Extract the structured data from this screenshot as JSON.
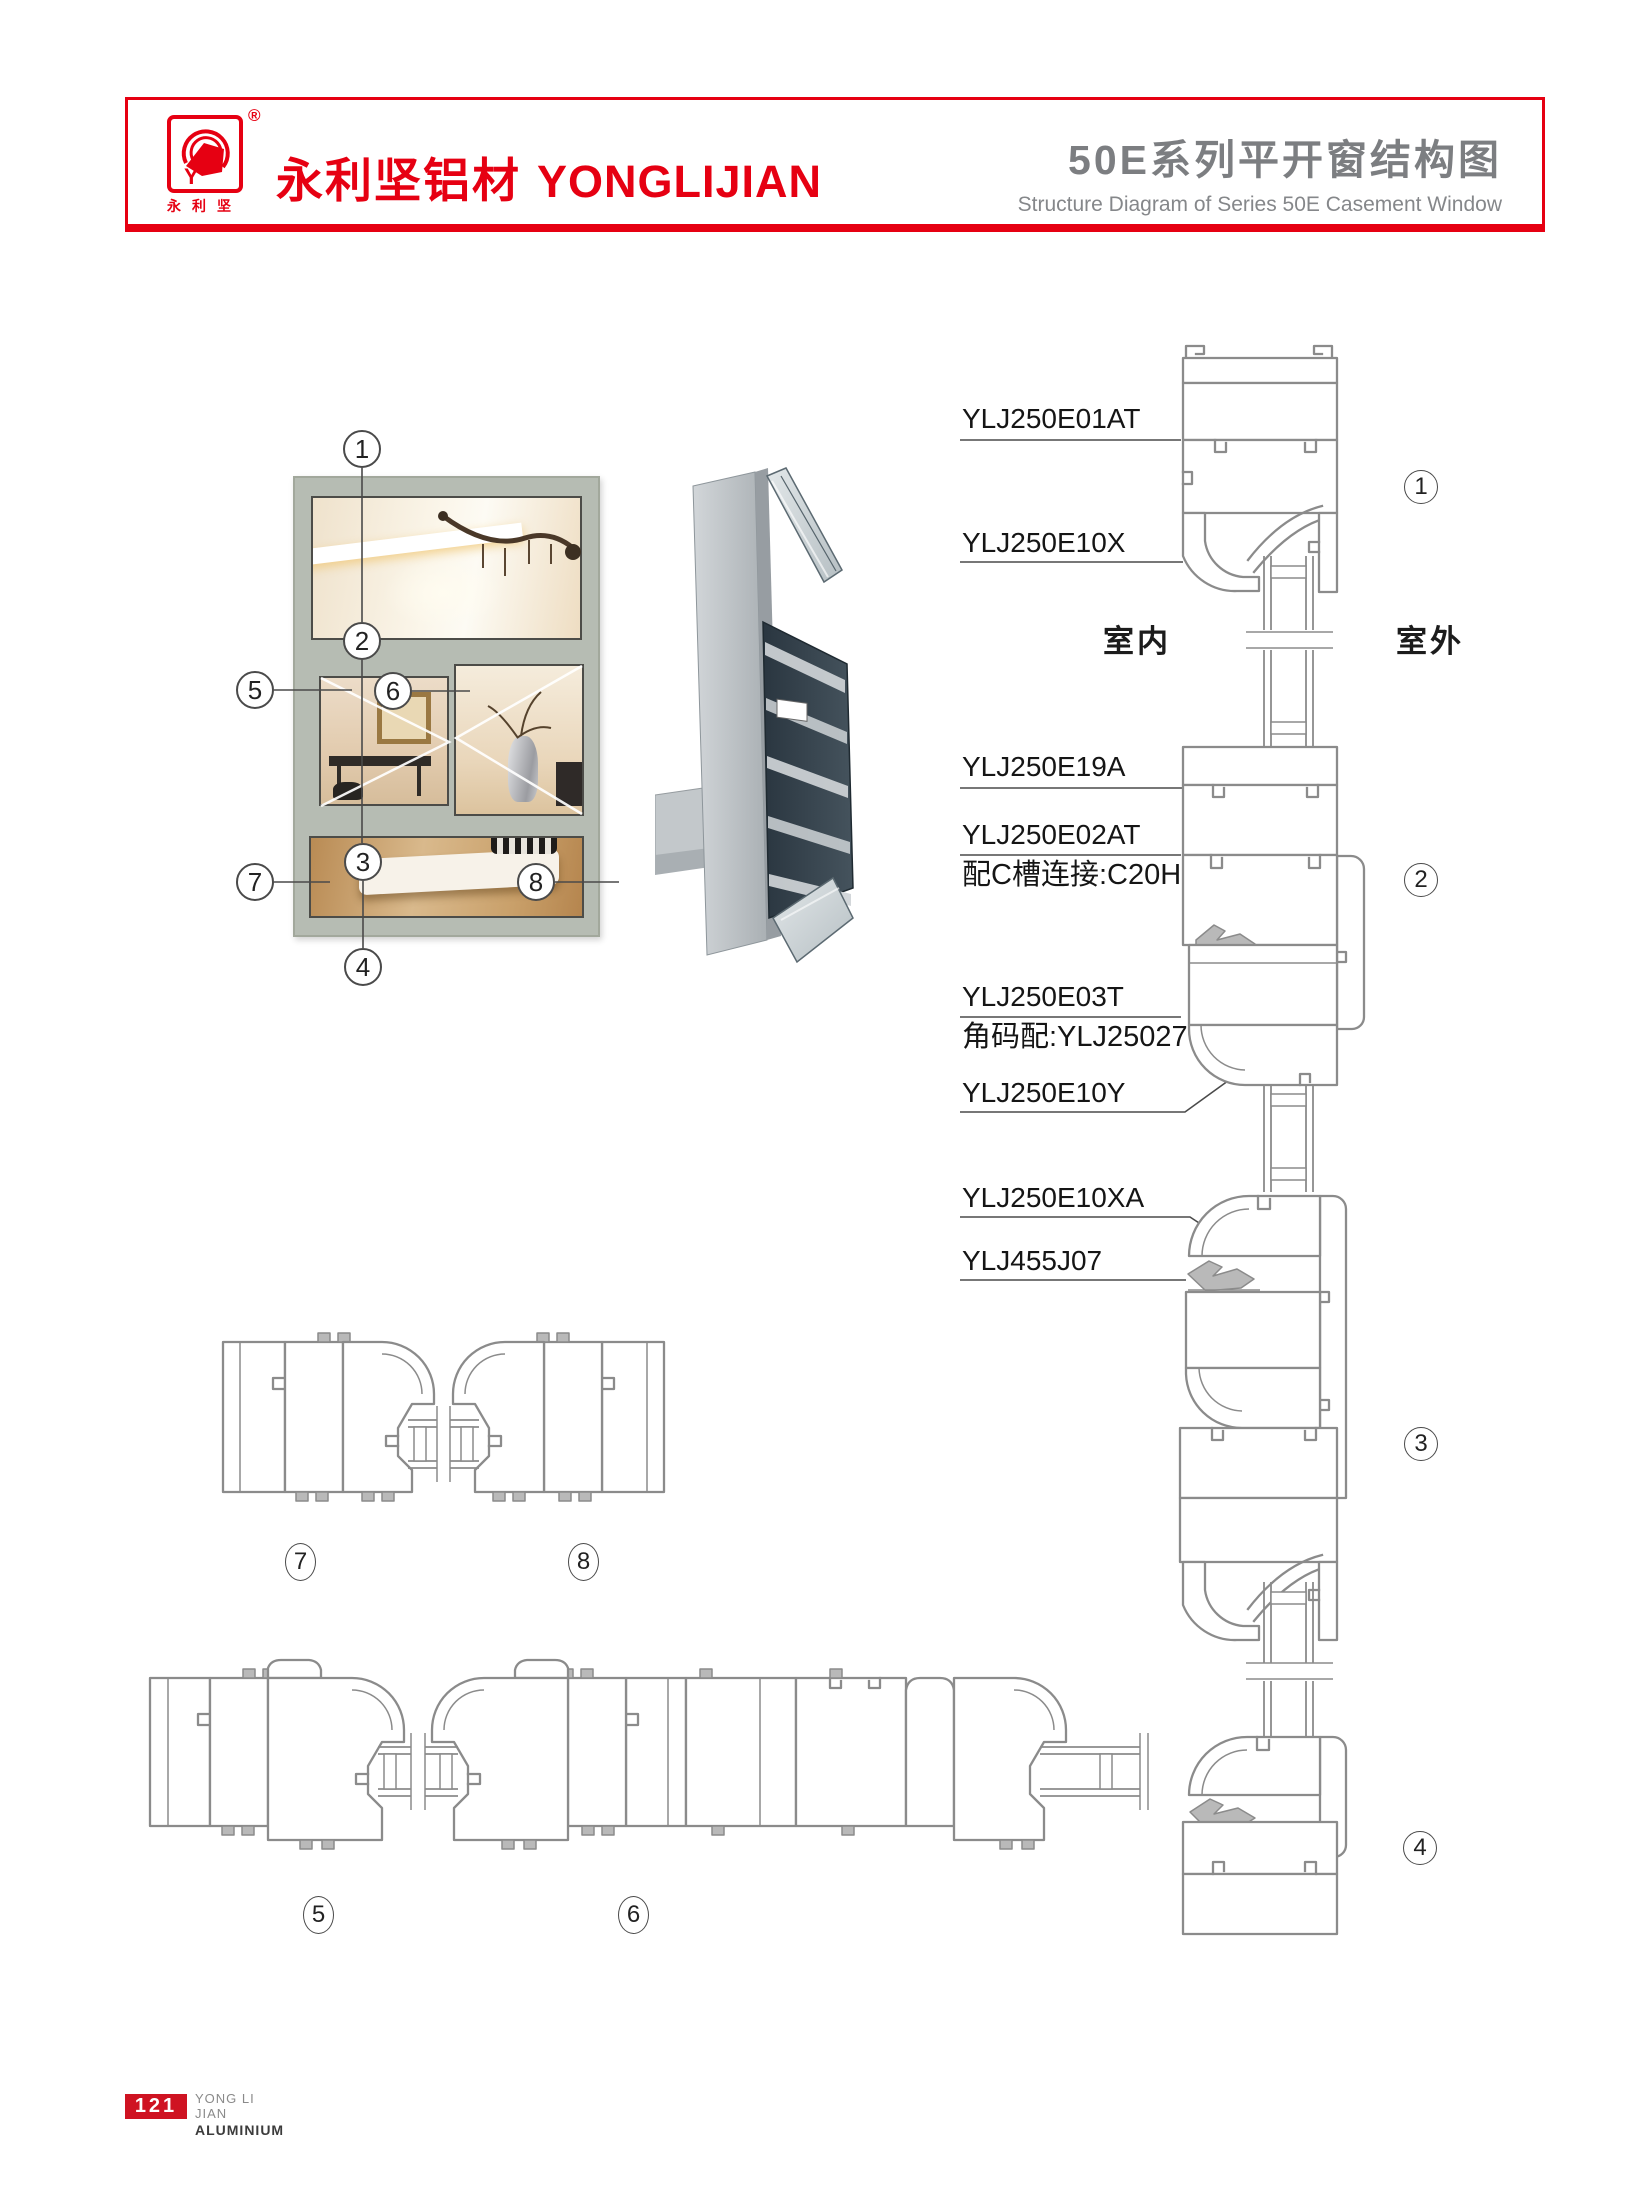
{
  "header": {
    "brand_zh": "永利坚铝材",
    "brand_en": "YONGLIJIAN",
    "registered": "®",
    "logo_monogram": "Y",
    "logo_sub": "永利坚",
    "title_zh": "50E系列平开窗结构图",
    "title_en": "Structure Diagram of Series 50E Casement Window"
  },
  "diagram": {
    "side_left": "室内",
    "side_right": "室外",
    "labels": [
      {
        "text": "YLJ250E01AT"
      },
      {
        "text": "YLJ250E10X"
      },
      {
        "text": "YLJ250E19A"
      },
      {
        "text": "YLJ250E02AT",
        "sub": "配C槽连接:C20H"
      },
      {
        "text": "YLJ250E03T",
        "sub": "角码配:YLJ25027"
      },
      {
        "text": "YLJ250E10Y"
      },
      {
        "text": "YLJ250E10XA"
      },
      {
        "text": "YLJ455J07"
      }
    ],
    "window_callouts": [
      "1",
      "2",
      "3",
      "4",
      "5",
      "6",
      "7",
      "8"
    ],
    "section_callouts": [
      "1",
      "2",
      "3",
      "4"
    ],
    "plan_callouts": [
      "5",
      "6",
      "7",
      "8"
    ]
  },
  "footer": {
    "page_number": "121",
    "company_line1": "YONG LI JIAN",
    "company_line2": "ALUMINIUM"
  },
  "colors": {
    "brand_red": "#e60012",
    "title_gray": "#7c7e81",
    "drawing_gray": "#8b8b8b"
  }
}
